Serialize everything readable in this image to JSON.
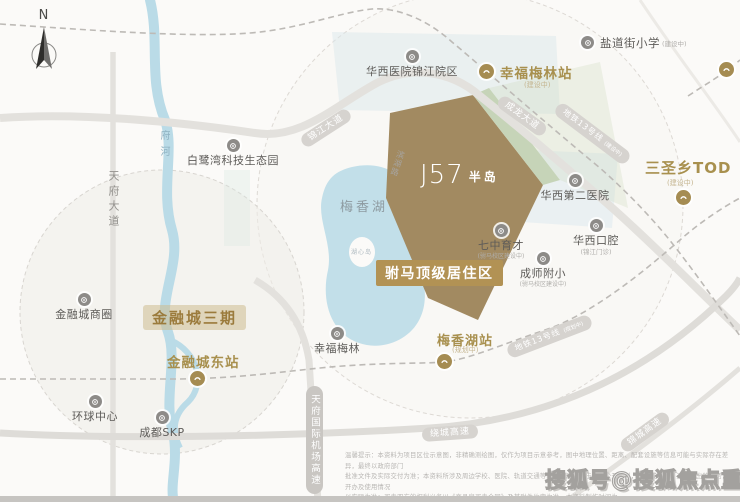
{
  "compass": {
    "label": "N"
  },
  "site": {
    "logo_main": "J57",
    "logo_sub": "半岛"
  },
  "badges": {
    "fuma": "驸马顶级居住区",
    "financial_city_phase3": "金融城三期"
  },
  "lake": {
    "name": "梅香湖",
    "island": "湖心岛"
  },
  "river": {
    "name": "府河"
  },
  "roads": {
    "jinjiang_avenue": "锦江大道",
    "chenglong_avenue": "成龙大道",
    "tianfu_avenue": "天府大道",
    "airport_expressway": "天府国际机场高速",
    "ring_expressway": "绕城高速",
    "jincheng_expressway": "锦城高速",
    "binhu_road": "滨湖路"
  },
  "metro": {
    "line13_upper": {
      "label": "地铁13号线",
      "status": "(建设中)"
    },
    "line13_lower": {
      "label": "地铁13号线",
      "status": "(规划中)"
    }
  },
  "stations": {
    "xingfumeilin": {
      "label": "幸福梅林站",
      "status": "(建设中)"
    },
    "jinrongchengdong": {
      "label": "金融城东站"
    },
    "meixianghu": {
      "label": "梅香湖站",
      "status": "(规划中)"
    },
    "sanshengxiang": {
      "label": "三圣乡TOD",
      "status": "(建设中)"
    }
  },
  "pois": {
    "yandaojie": {
      "label": "盐道街小学",
      "note": "(建设中)"
    },
    "huaxi_jinjiang": {
      "label": "华西医院锦江院区"
    },
    "bailuwan": {
      "label": "白鹭湾科技生态园"
    },
    "huaxi_second": {
      "label": "华西第二医院"
    },
    "huaxi_dental": {
      "label": "华西口腔",
      "note": "(锦江门诊)"
    },
    "qizhong": {
      "label": "七中育才",
      "note": "(驸马校区建设中)"
    },
    "chengshi": {
      "label": "成师附小",
      "note": "(驸马校区建设中)"
    },
    "jinrongcheng_shangquan": {
      "label": "金融城商圈"
    },
    "huanqiu": {
      "label": "环球中心"
    },
    "skp": {
      "label": "成都SKP"
    },
    "xingfumeilin_park": {
      "label": "幸福梅林"
    }
  },
  "disclaimer": {
    "lines": [
      "温馨提示：本资料为项目区位示意图，非精确测绘图，仅作为项目示意参考，图中地理位置、距离、配套设施等信息可能与实际存在差异，最终以政府部门",
      "批准文件及实际交付为准；本资料所涉及周边学校、医院、轨道交通等配套信息来源于政府公开资料，不构成本项目对其作出的承诺，开办及使用情况",
      "以实际为准；买卖双方的权利义务以《商品房买卖合同》及其附件约定为准。本资料制作时间为",
      "2020年7月。"
    ]
  },
  "watermark": "搜狐号@搜狐焦点重庆站"
}
